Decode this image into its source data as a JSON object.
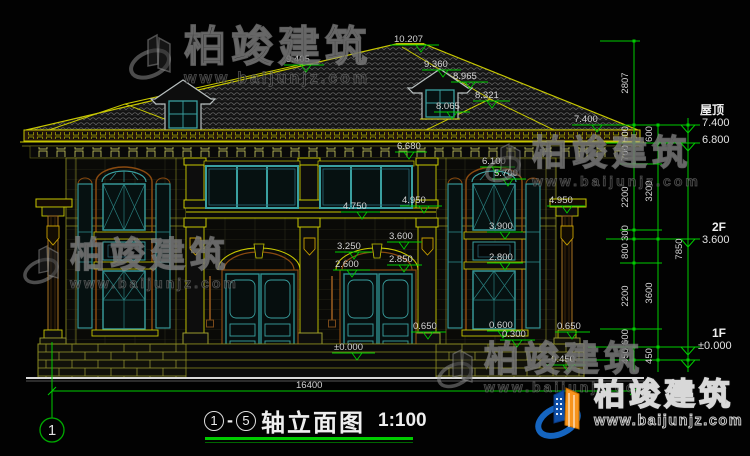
{
  "brand": {
    "name": "柏竣建筑",
    "url": "www.baijunjz.com"
  },
  "title_block": {
    "axis_start": "1",
    "dash": "-",
    "axis_end": "5",
    "label": "轴立面图",
    "scale": "1:100"
  },
  "footer": {
    "total_width": "16400",
    "axis_bubble": "1"
  },
  "levels": {
    "floor_labels": {
      "roof": "屋顶",
      "roof_elev": "7.400",
      "roof_elev2": "6.800",
      "f2": "2F",
      "f2_elev": "3.600",
      "f1": "1F",
      "f1_elev": "±0.000"
    },
    "chain_a": [
      "2807",
      "600",
      "700",
      "2200",
      "300",
      "800",
      "2200",
      "600",
      "450"
    ],
    "chain_b": [
      "600",
      "3200",
      "3600",
      "450"
    ],
    "total_height": "7850"
  },
  "elevation_markers": [
    "10.207",
    "9.405",
    "9.360",
    "8.965",
    "8.321",
    "8.065",
    "7.400",
    "6.680",
    "6.100",
    "5.700",
    "4.950",
    "4.950",
    "4.750",
    "3.900",
    "3.600",
    "3.250",
    "2.850",
    "2.800",
    "2.600",
    "0.650",
    "0.650",
    "0.600",
    "0.300",
    "±0.000",
    "-0.450"
  ],
  "colors": {
    "cad_yellow": "#c8c800",
    "cad_green": "#00cc00",
    "window_teal": "#3aa0a0",
    "arch_brown": "#8a4a10",
    "brand_blue": "#1565c0",
    "brand_orange": "#f7941d",
    "background": "#000000",
    "text_white": "#e2e2e2"
  }
}
